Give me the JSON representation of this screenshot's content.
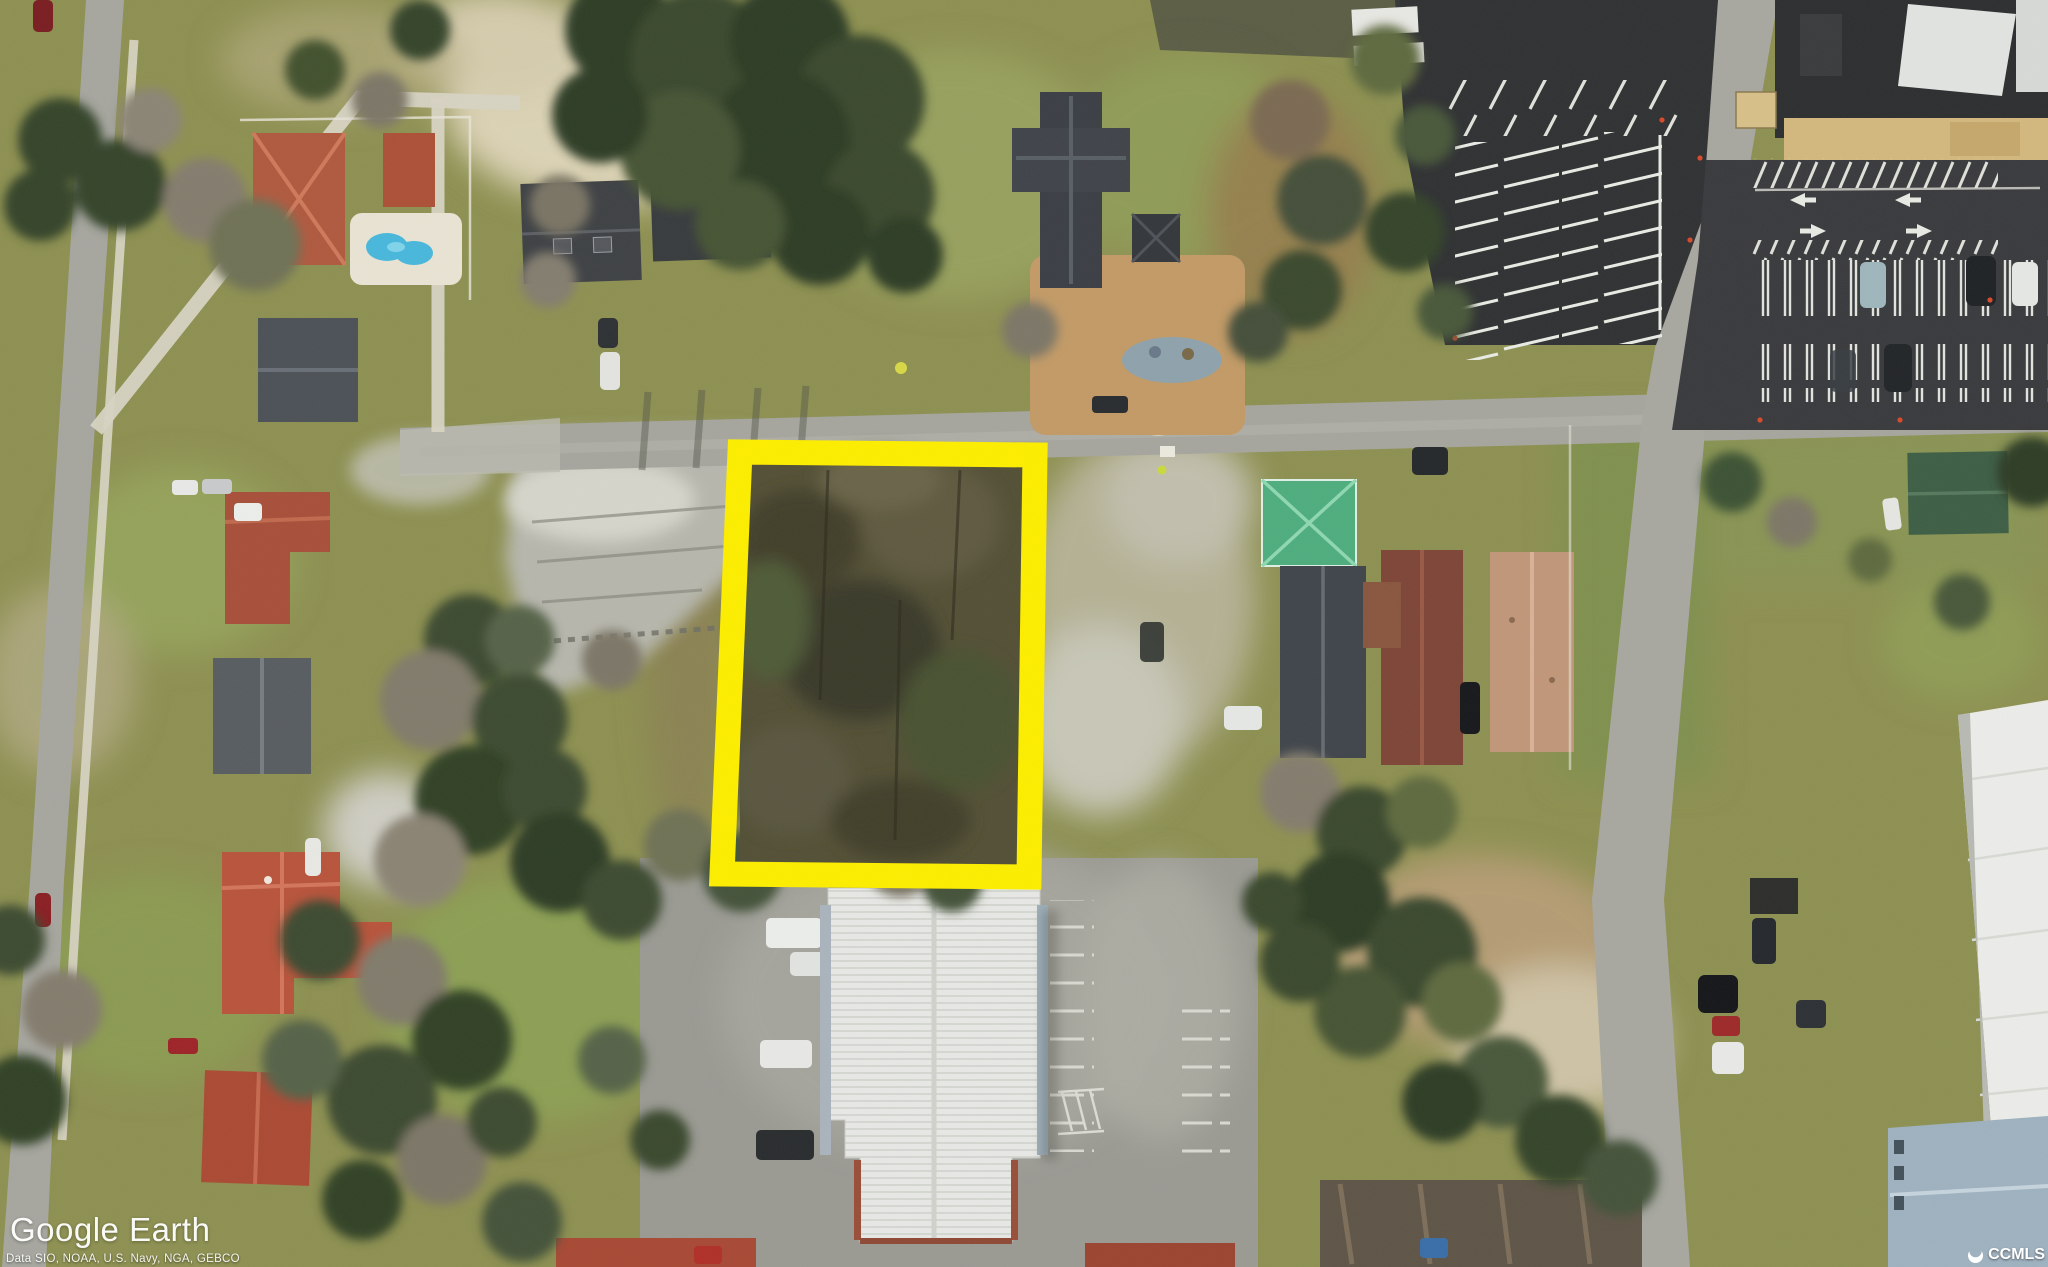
{
  "map": {
    "provider_logo": "Google Earth",
    "attribution": "Data SIO, NOAA, U.S. Navy, NGA, GEBCO",
    "mls_watermark": "CCMLS"
  },
  "highlight": {
    "color": "#FDEE00"
  },
  "palette": {
    "grass_base": "#8e9152",
    "road_gray": "#a6a69f",
    "asphalt_dark": "#303234",
    "roof_terracotta": "#b05a40",
    "roof_dark_gray": "#3c4046",
    "roof_green_metal": "#4fae7e",
    "roof_maroon": "#7e4638",
    "roof_salmon": "#c2977a",
    "roof_white_metal": "#e8e9e6",
    "roof_blue_gray": "#9fb2c0",
    "sand": "#dcd3b6"
  }
}
